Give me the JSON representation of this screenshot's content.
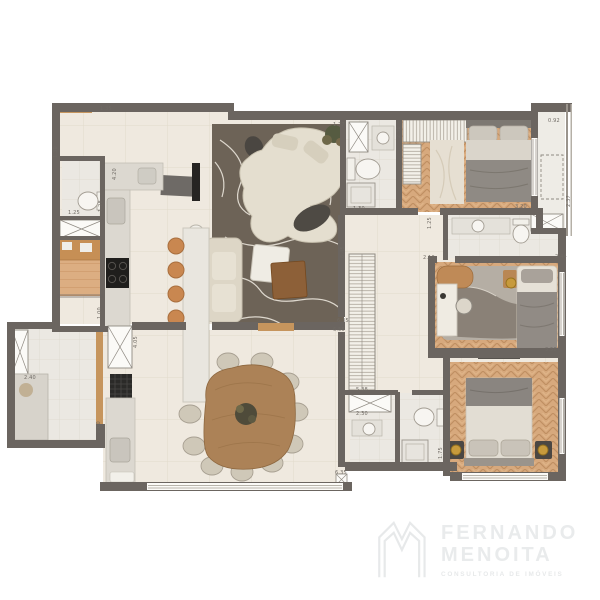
{
  "branding": {
    "name_line1": "FERNANDO",
    "name_line2": "MENOITA",
    "tagline": "CONSULTORIA DE IMÓVEIS"
  },
  "palette": {
    "wall": "#6b6560",
    "floor_tile": "#efe9df",
    "floor_tile_light": "#ebe8e2",
    "wood_floor": "#d7a97d",
    "rug_dark": "#6d6357",
    "accent_wood": "#c6955d",
    "stool": "#c98750",
    "lamp_gold": "#c79a3c",
    "dim_text": "#6f6a64",
    "logo_gray": "#e9ebec"
  },
  "floorplan": {
    "dimension_labels": [
      {
        "text": "1.35",
        "x": 100,
        "y": 110,
        "rot": 0
      },
      {
        "text": "1.30",
        "x": 57,
        "y": 158,
        "rot": -90
      },
      {
        "text": "1.25",
        "x": 68,
        "y": 214,
        "rot": 0
      },
      {
        "text": "1.28",
        "x": 102,
        "y": 212,
        "rot": -90
      },
      {
        "text": "4.20",
        "x": 116,
        "y": 180,
        "rot": -90
      },
      {
        "text": "2.40",
        "x": 24,
        "y": 379,
        "rot": 0
      },
      {
        "text": "1.00",
        "x": 101,
        "y": 319,
        "rot": -90
      },
      {
        "text": "2.00",
        "x": 100,
        "y": 433,
        "rot": -90
      },
      {
        "text": "4.05",
        "x": 137,
        "y": 348,
        "rot": -90
      },
      {
        "text": "6.45",
        "x": 344,
        "y": 258,
        "rot": -90
      },
      {
        "text": "6.35",
        "x": 337,
        "y": 322,
        "rot": 0
      },
      {
        "text": "6.55",
        "x": 333,
        "y": 331,
        "rot": 0
      },
      {
        "text": "5.38",
        "x": 356,
        "y": 391,
        "rot": 0
      },
      {
        "text": "2.30",
        "x": 356,
        "y": 415,
        "rot": 0
      },
      {
        "text": "6.35",
        "x": 335,
        "y": 474,
        "rot": 0
      },
      {
        "text": "1.75",
        "x": 442,
        "y": 459,
        "rot": -90
      },
      {
        "text": "3.50",
        "x": 545,
        "y": 351,
        "rot": 0
      },
      {
        "text": "2.44",
        "x": 555,
        "y": 258,
        "rot": 0
      },
      {
        "text": "2.10",
        "x": 423,
        "y": 259,
        "rot": 0
      },
      {
        "text": "3.20",
        "x": 515,
        "y": 208,
        "rot": 0
      },
      {
        "text": "1.25",
        "x": 431,
        "y": 229,
        "rot": -90
      },
      {
        "text": "0.92",
        "x": 548,
        "y": 122,
        "rot": 0
      },
      {
        "text": "2.37",
        "x": 570,
        "y": 207,
        "rot": -90
      },
      {
        "text": "2.30",
        "x": 400,
        "y": 138,
        "rot": -90
      },
      {
        "text": "1.77",
        "x": 333,
        "y": 126,
        "rot": 0
      },
      {
        "text": "1.30",
        "x": 353,
        "y": 210,
        "rot": 0
      }
    ]
  }
}
